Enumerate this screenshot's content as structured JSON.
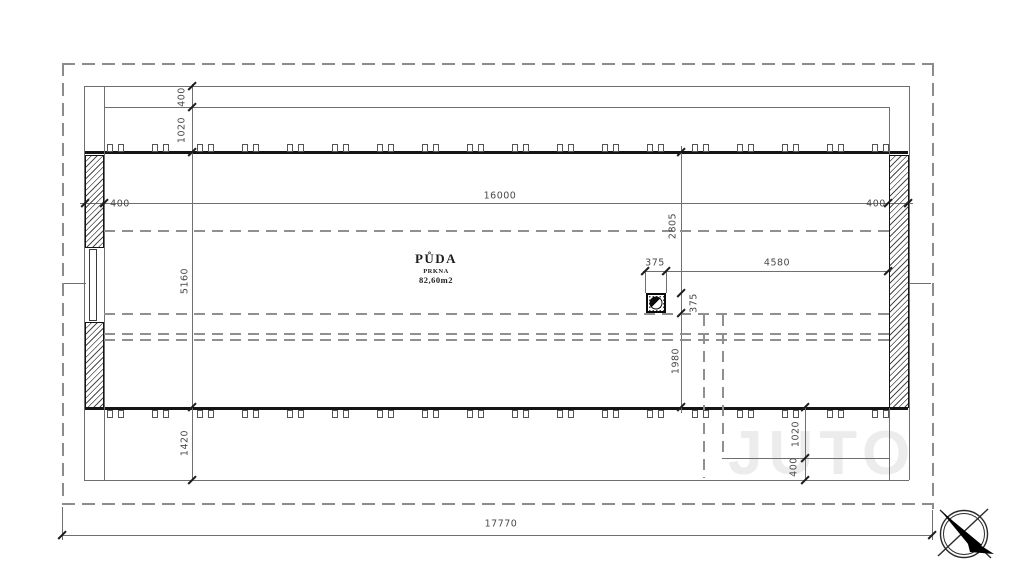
{
  "page": {
    "type": "architectural-floor-plan",
    "floor": "attic"
  },
  "room": {
    "name": "PŮDA",
    "material": "PRKNA",
    "area": "82,60m2"
  },
  "dims": {
    "top_left_wall": "400",
    "top_span": "16000",
    "top_right_wall": "400",
    "left_eave_offset": "400",
    "left_overhang": "1020",
    "left_interior_width": "5160",
    "left_bottom_overhang": "1420",
    "chimney_offset_top": "2805",
    "chimney_width": "375",
    "chimney_height": "375",
    "chimney_to_right_wall": "4580",
    "chimney_offset_bottom": "1980",
    "bottom_right_overhang": "1020",
    "bottom_right_eave_offset": "400",
    "overall_width": "17770"
  },
  "watermark": "JUTO",
  "icons": {
    "north_arrow": "compass-north-arrow-icon",
    "chimney": "chimney-flue-icon"
  },
  "colors": {
    "wall": "#141414",
    "line": "#6f6f6f",
    "dashed": "#909090",
    "dim_text": "#4a4a4a",
    "watermark": "#ececec"
  }
}
